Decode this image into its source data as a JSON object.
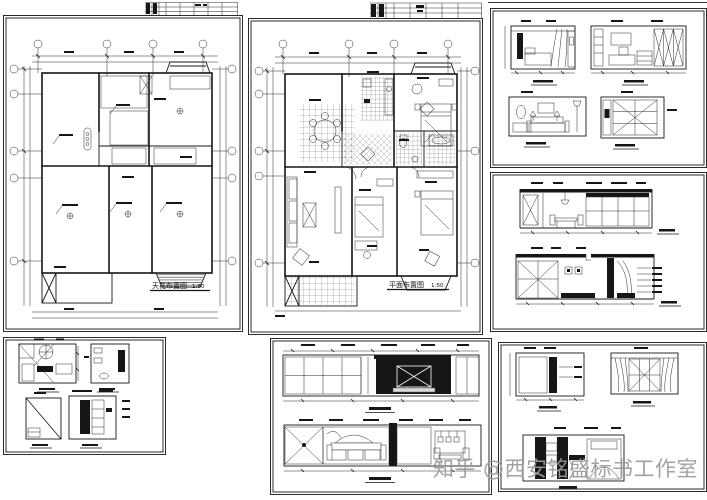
{
  "document": {
    "kind": "interior-design CAD drawing set",
    "paper_color": "#ffffff",
    "ink_color": "#161616"
  },
  "sheets": {
    "ceiling_plan": {
      "title": "天花布置图",
      "scale": "1:60"
    },
    "floor_plan": {
      "title": "平面布置图",
      "scale": "1:50"
    }
  },
  "watermark": {
    "prefix": "知乎",
    "handle": "@西安铭盛标书工作室",
    "color": "#9c9c9c"
  }
}
